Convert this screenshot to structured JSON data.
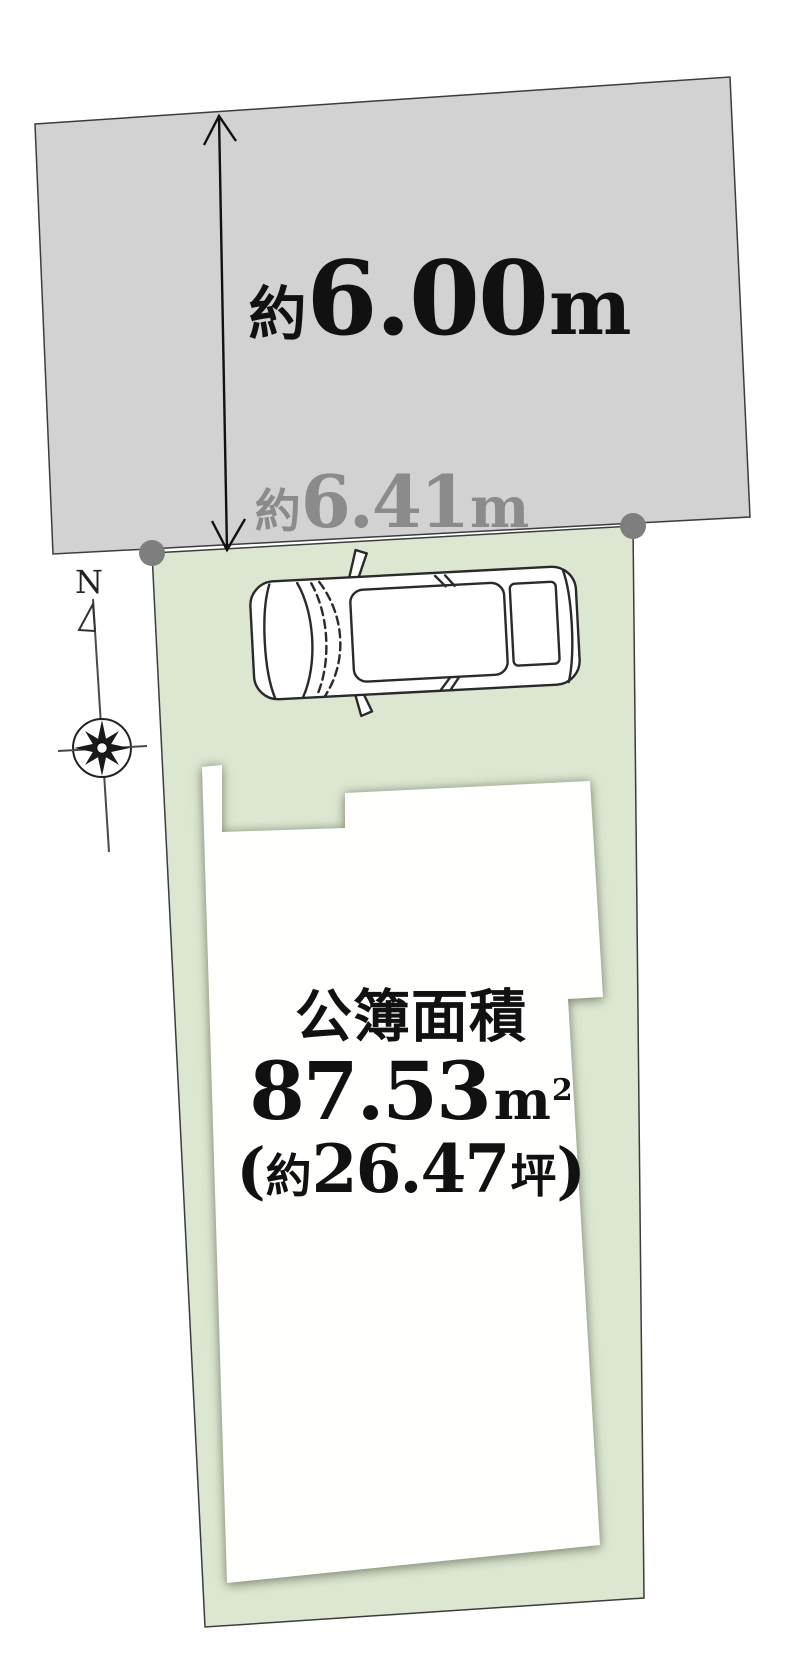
{
  "diagram": {
    "type": "land-plot-diagram",
    "road": {
      "depth_label": {
        "approx": "約",
        "value": "6.00",
        "unit": "m"
      }
    },
    "frontage_label": {
      "approx": "約",
      "value": "6.41",
      "unit": "m"
    },
    "lot": {
      "area_title": "公簿面積",
      "area": {
        "value": "87.53",
        "unit_base": "m",
        "unit_exp": "2"
      },
      "tsubo": {
        "open": "(",
        "approx": "約",
        "value": "26.47",
        "unit": "坪",
        "close": ")"
      }
    },
    "compass": {
      "north_label": "N"
    },
    "colors": {
      "road_fill": "#d2d2d2",
      "lot_fill": "#dde6d1",
      "footprint_fill": "#fffffe",
      "marker_fill": "#7e7e7e",
      "secondary_text": "#8b8b8b",
      "primary_text": "#111111"
    }
  }
}
